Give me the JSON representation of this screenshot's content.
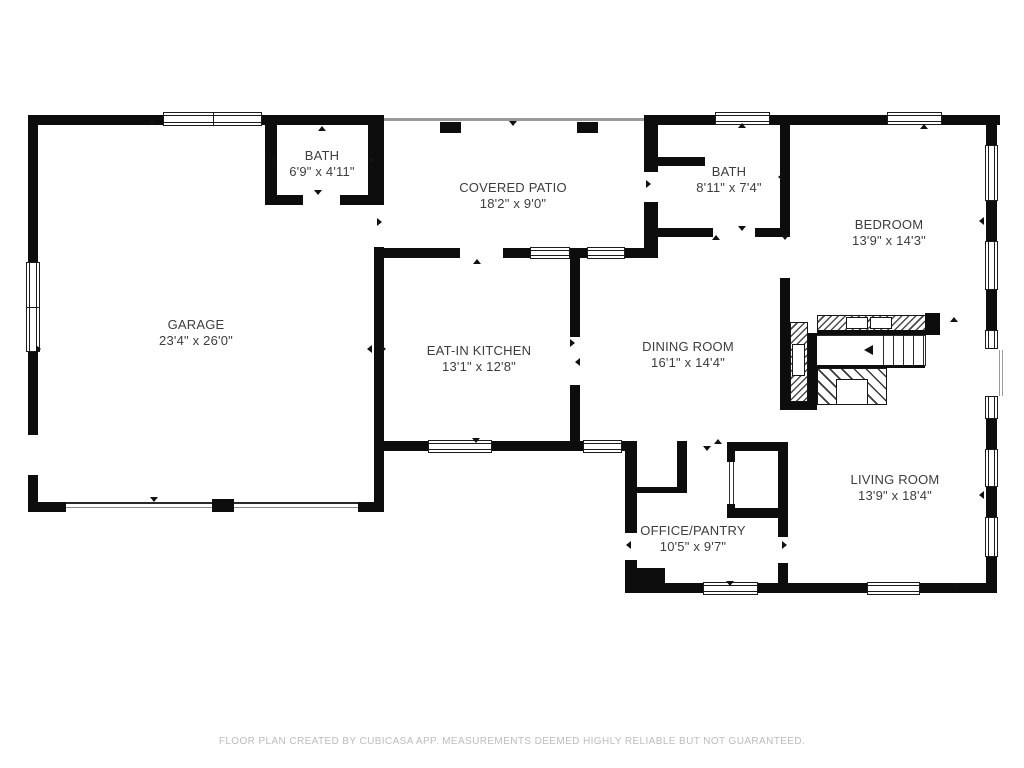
{
  "title": "Floor plan",
  "rooms": [
    {
      "name": "BATH",
      "dims": "6'9\" x 4'11\""
    },
    {
      "name": "COVERED PATIO",
      "dims": "18'2\" x 9'0\""
    },
    {
      "name": "BATH",
      "dims": "8'11\" x 7'4\""
    },
    {
      "name": "BEDROOM",
      "dims": "13'9\" x 14'3\""
    },
    {
      "name": "GARAGE",
      "dims": "23'4\" x 26'0\""
    },
    {
      "name": "EAT-IN KITCHEN",
      "dims": "13'1\" x 12'8\""
    },
    {
      "name": "DINING ROOM",
      "dims": "16'1\" x 14'4\""
    },
    {
      "name": "LIVING ROOM",
      "dims": "13'9\" x 18'4\""
    },
    {
      "name": "OFFICE/PANTRY",
      "dims": "10'5\" x 9'7\""
    }
  ],
  "footer": {
    "text": "FLOOR PLAN CREATED BY CUBICASA APP. MEASUREMENTS DEEMED HIGHLY RELIABLE BUT NOT GUARANTEED."
  },
  "colors": {
    "wall": "#0d0d0d",
    "label_text": "#3d3d3d",
    "footer_text": "#bcbcbc",
    "thin_line": "#9a9a9a",
    "background": "#ffffff"
  }
}
